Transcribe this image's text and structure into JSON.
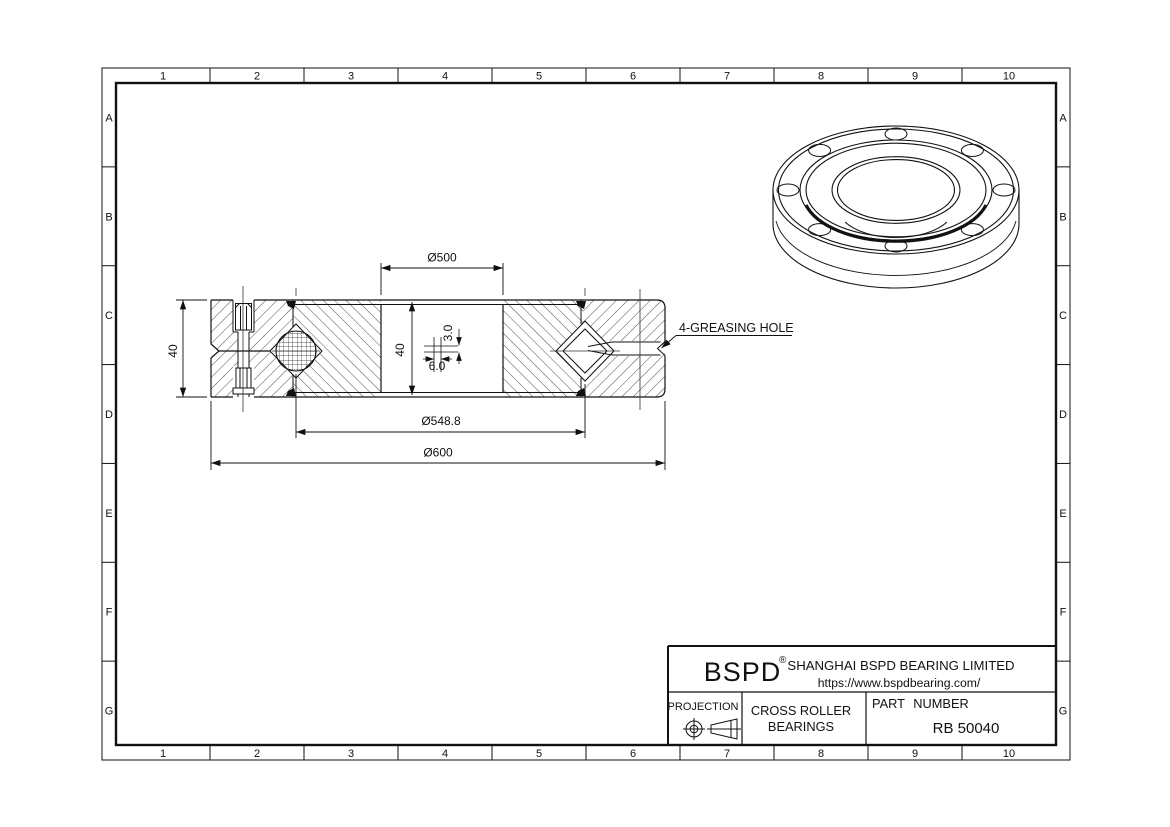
{
  "grid": {
    "cols": [
      "1",
      "2",
      "3",
      "4",
      "5",
      "6",
      "7",
      "8",
      "9",
      "10"
    ],
    "rows": [
      "A",
      "B",
      "C",
      "D",
      "E",
      "F",
      "G"
    ]
  },
  "drawing": {
    "dims": {
      "bore": "Ø500",
      "pitch": "Ø548.8",
      "od": "Ø600",
      "width": "40",
      "width_inner": "40",
      "grease_offset": "3.0",
      "grease_dia": "6.0"
    },
    "labels": {
      "greasing": "4-GREASING HOLE"
    }
  },
  "title_block": {
    "logo": "BSPD",
    "registered": "®",
    "company": "SHANGHAI BSPD BEARING LIMITED",
    "website": "https://www.bspdbearing.com/",
    "projection_label": "PROJECTION",
    "product_line1": "CROSS ROLLER",
    "product_line2": "BEARINGS",
    "part_number_label": "PART NUMBER",
    "part_number": "RB 50040"
  },
  "colors": {
    "line": "#111111",
    "paper": "#ffffff"
  }
}
